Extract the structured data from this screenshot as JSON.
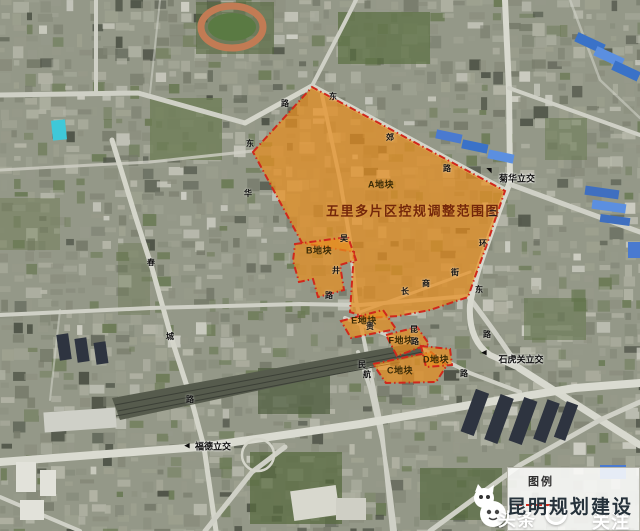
{
  "map": {
    "title": "五里多片区控规调整范围图",
    "title_pos": {
      "x": 413,
      "y": 211
    },
    "parcels": [
      {
        "id": "A",
        "label": "A地块",
        "label_x": 381,
        "label_y": 185,
        "points": "253,152 312,87 505,191 497,214 486,247 476,274 468,297 430,310 398,316 368,318 350,312 354,252 302,243"
      },
      {
        "id": "B",
        "label": "B地块",
        "label_x": 319,
        "label_y": 251,
        "points": "295,244 348,237 356,260 340,265 344,290 318,297 313,279 299,282 293,261"
      },
      {
        "id": "E",
        "label": "E地块",
        "label_x": 364,
        "label_y": 321,
        "points": "341,321 383,310 396,329 351,338"
      },
      {
        "id": "F",
        "label": "F地块",
        "label_x": 401,
        "label_y": 341,
        "points": "386,335 417,327 429,344 397,356"
      },
      {
        "id": "C",
        "label": "C地块",
        "label_x": 400,
        "label_y": 371,
        "points": "373,364 431,352 447,365 436,382 386,383"
      },
      {
        "id": "D",
        "label": "D地块",
        "label_x": 436,
        "label_y": 360,
        "points": "421,346 450,349 452,365 426,367"
      }
    ],
    "interchanges": [
      {
        "text": "菊华立交",
        "x": 517,
        "y": 179
      },
      {
        "text": "石虎关立交",
        "x": 521,
        "y": 360
      },
      {
        "text": "福德立交",
        "x": 213,
        "y": 447
      }
    ],
    "arrows": [
      {
        "glyph": "◥",
        "x": 489,
        "y": 171
      },
      {
        "glyph": "◀",
        "x": 484,
        "y": 353
      },
      {
        "glyph": "◀",
        "x": 187,
        "y": 446
      }
    ],
    "road_chars": [
      {
        "t": "路",
        "x": 285,
        "y": 104
      },
      {
        "t": "东",
        "x": 333,
        "y": 97
      },
      {
        "t": "郊",
        "x": 390,
        "y": 138
      },
      {
        "t": "路",
        "x": 447,
        "y": 169
      },
      {
        "t": "东",
        "x": 250,
        "y": 144
      },
      {
        "t": "华",
        "x": 248,
        "y": 194
      },
      {
        "t": "吴",
        "x": 344,
        "y": 239
      },
      {
        "t": "井",
        "x": 336,
        "y": 271
      },
      {
        "t": "路",
        "x": 329,
        "y": 296
      },
      {
        "t": "春",
        "x": 151,
        "y": 263
      },
      {
        "t": "城",
        "x": 170,
        "y": 337
      },
      {
        "t": "路",
        "x": 190,
        "y": 400
      },
      {
        "t": "二",
        "x": 493,
        "y": 214
      },
      {
        "t": "环",
        "x": 483,
        "y": 244
      },
      {
        "t": "东",
        "x": 479,
        "y": 290
      },
      {
        "t": "路",
        "x": 487,
        "y": 335
      },
      {
        "t": "长",
        "x": 405,
        "y": 292
      },
      {
        "t": "商",
        "x": 426,
        "y": 284
      },
      {
        "t": "街",
        "x": 455,
        "y": 273
      },
      {
        "t": "贵",
        "x": 370,
        "y": 327
      },
      {
        "t": "昆",
        "x": 414,
        "y": 330
      },
      {
        "t": "路",
        "x": 415,
        "y": 342
      },
      {
        "t": "民",
        "x": 362,
        "y": 365
      },
      {
        "t": "航",
        "x": 367,
        "y": 375
      },
      {
        "t": "路",
        "x": 464,
        "y": 374
      }
    ],
    "overlay_fill": "rgba(231,143,32,0.72)",
    "overlay_stroke": "#d0281c"
  },
  "legend": {
    "title": "图例"
  },
  "watermark": {
    "platform": "头条",
    "brand": "昆明规划建设",
    "follow": "关注"
  },
  "colors": {
    "accent_orange": "#e78f20",
    "boundary_red": "#d0281c",
    "title_text": "#73270a"
  }
}
